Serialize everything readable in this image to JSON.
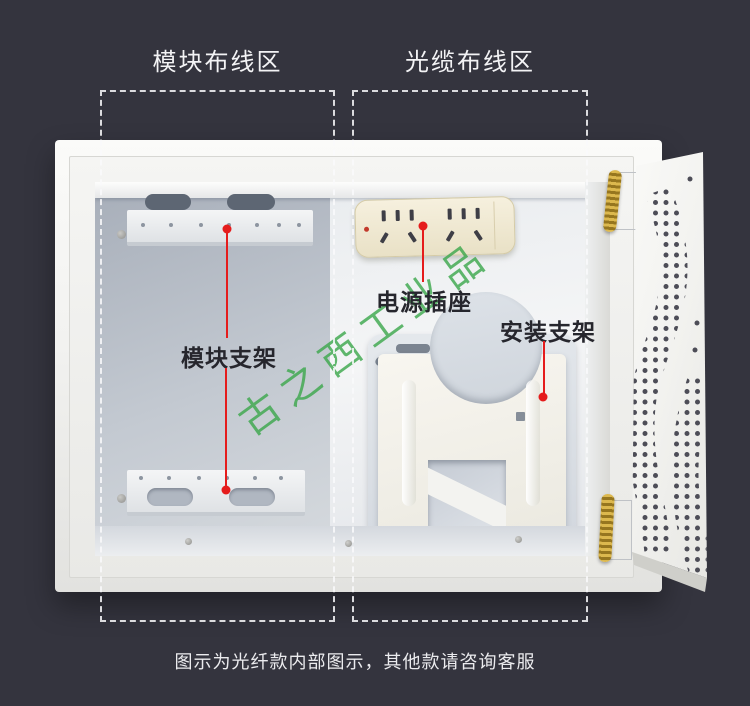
{
  "scene": {
    "background_color": "#34343e",
    "accent_red": "#e51c1c",
    "watermark_text": "古之西工业品",
    "watermark_color": "#3aa64a",
    "caption": "图示为光纤款内部图示，其他款请咨询客服"
  },
  "regions": {
    "module_zone_label": "模块布线区",
    "fiber_zone_label": "光缆布线区"
  },
  "parts": {
    "module_bracket_label": "模块支架",
    "power_socket_label": "电源插座",
    "mount_bracket_label": "安装支架"
  }
}
